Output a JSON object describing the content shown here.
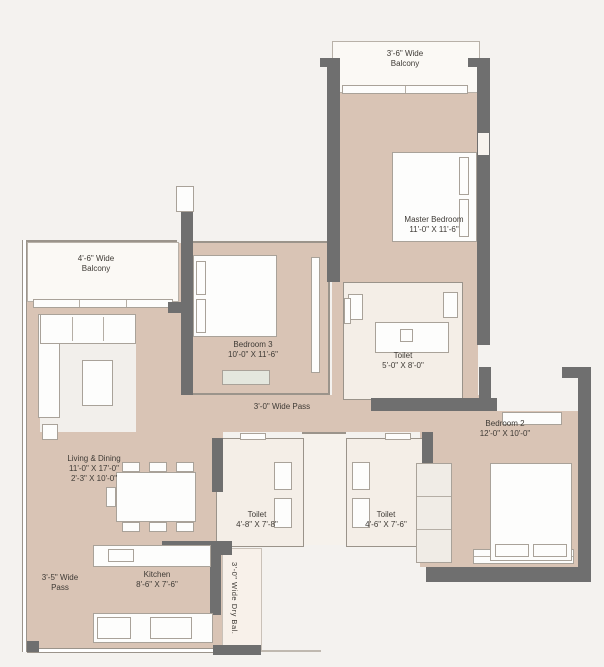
{
  "plan": {
    "type": "apartment-floor-plan",
    "rooms": {
      "balcony_top": {
        "l1": "3'-6\" Wide",
        "l2": "Balcony"
      },
      "master": {
        "name": "Master Bedroom",
        "dims": "11'-0\" X 11'-6\""
      },
      "bedroom3": {
        "name": "Bedroom 3",
        "dims": "10'-0\" X 11'-6\""
      },
      "toilet_master": {
        "name": "Toilet",
        "dims": "5'-0\" X 8'-0\""
      },
      "pass_center": {
        "label": "3'-0\" Wide Pass"
      },
      "bedroom2": {
        "name": "Bedroom 2",
        "dims": "12'-0\" X 10'-0\""
      },
      "living": {
        "name": "Living & Dining",
        "dims1": "11'-0\" X 17'-0\"",
        "dims2": "2'-3\" X 10'-0\""
      },
      "balcony_left": {
        "l1": "4'-6\" Wide",
        "l2": "Balcony"
      },
      "toilet_left": {
        "name": "Toilet",
        "dims": "4'-8\" X 7'-8\""
      },
      "toilet_right": {
        "name": "Toilet",
        "dims": "4'-6\" X 7'-6\""
      },
      "kitchen": {
        "name": "Kitchen",
        "dims": "8'-6\" X 7'-6\""
      },
      "pass_left": {
        "l1": "3'-5\" Wide",
        "l2": "Pass"
      },
      "dry_balcony": {
        "label": "3'-0\" Wide Dry Bal."
      }
    },
    "colors": {
      "background": "#f4f2ef",
      "floor": "#d9c4b5",
      "wall": "#6f6f6f",
      "balcony": "#fbf9f5",
      "toilet_floor": "#f4eee7",
      "text": "#3e3a35"
    }
  }
}
